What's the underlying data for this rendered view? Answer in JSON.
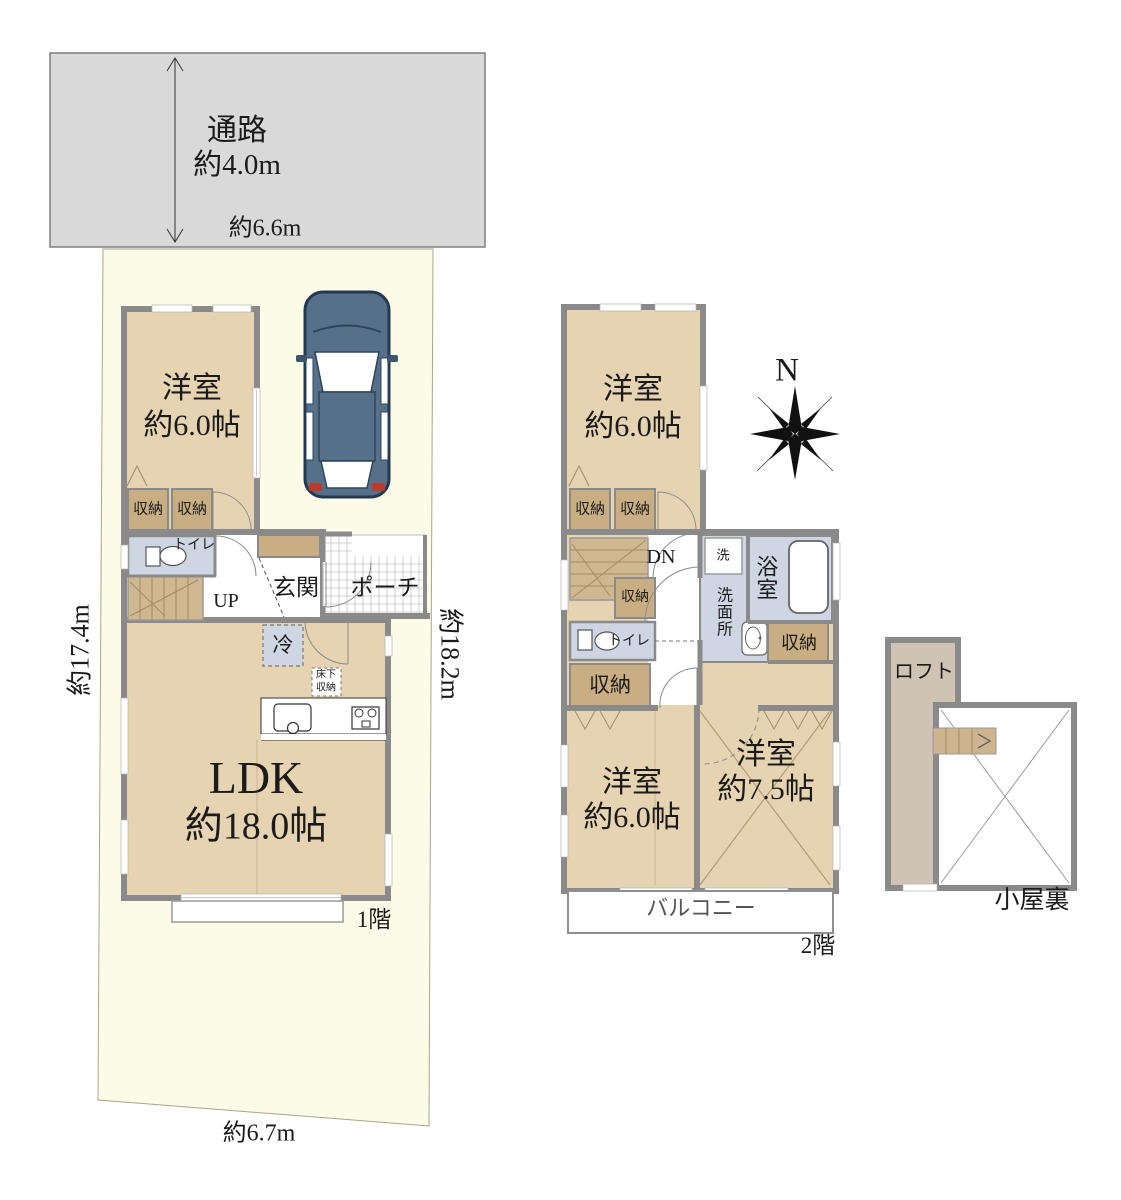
{
  "road": {
    "label": "通路",
    "depth": "約4.0m",
    "frontage": "約6.6m"
  },
  "site": {
    "west": "約17.4m",
    "east": "約18.2m",
    "south": "約6.7m"
  },
  "floor1": {
    "label": "1階",
    "bedroom": {
      "name": "洋室",
      "size": "約6.0帖"
    },
    "storage_a": "収納",
    "storage_b": "収納",
    "toilet": "トイレ",
    "stairs": "UP",
    "entrance": "玄関",
    "porch": "ポーチ",
    "fridge": "冷",
    "underfloor": "床下収納",
    "ldk": {
      "name": "LDK",
      "size": "約18.0帖"
    }
  },
  "floor2": {
    "label": "2階",
    "bedroom_n": {
      "name": "洋室",
      "size": "約6.0帖"
    },
    "storage_a": "収納",
    "storage_b": "収納",
    "storage_c": "収納",
    "storage_d": "収納",
    "storage_e": "収納",
    "stairs": "DN",
    "toilet": "トイレ",
    "washer": "洗",
    "washroom": "洗面所",
    "bath": "浴室",
    "bedroom_sw": {
      "name": "洋室",
      "size": "約6.0帖"
    },
    "bedroom_se": {
      "name": "洋室",
      "size": "約7.5帖"
    },
    "balcony": "バルコニー"
  },
  "attic": {
    "loft": "ロフト",
    "label": "小屋裏"
  },
  "compass": {
    "north": "N"
  },
  "colors": {
    "site_cream": "#fcfbe7",
    "road_gray": "#d9d9d9",
    "wall_gray": "#8a8a8a",
    "floor_tan": "#e5d3b1",
    "closet_tan": "#c9ae83",
    "stair_tan": "#cfb890",
    "wet_blue": "#ced6e4",
    "loft_greige": "#cfc3b3",
    "car_body": "#57708a",
    "car_outline": "#23394f",
    "tail_red": "#c0392b"
  }
}
